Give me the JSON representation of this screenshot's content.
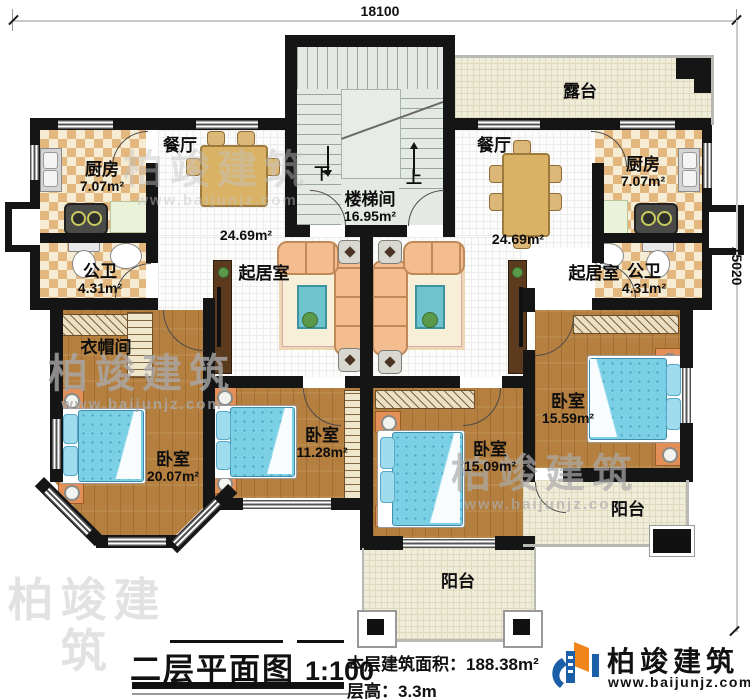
{
  "dimensions": {
    "width_top": "18100",
    "height_right": "15020"
  },
  "rooms": {
    "stairwell": {
      "name": "楼梯间",
      "area": "16.95m²"
    },
    "terrace": {
      "name": "露台"
    },
    "kitchen_left": {
      "name": "厨房",
      "area": "7.07m²"
    },
    "kitchen_right": {
      "name": "厨房",
      "area": "7.07m²"
    },
    "dining_left": {
      "name": "餐厅",
      "area": "24.69m²"
    },
    "dining_right": {
      "name": "餐厅",
      "area": "24.69m²"
    },
    "bath_left": {
      "name": "公卫",
      "area": "4.31m²"
    },
    "bath_right": {
      "name": "公卫",
      "area": "4.31m²"
    },
    "living_left": {
      "name": "起居室"
    },
    "living_right": {
      "name": "起居室"
    },
    "cloakroom": {
      "name": "衣帽间"
    },
    "bedroom_master_left": {
      "name": "卧室",
      "area": "20.07m²"
    },
    "bedroom_left_small": {
      "name": "卧室",
      "area": "11.28m²"
    },
    "bedroom_right_small": {
      "name": "卧室",
      "area": "15.09m²"
    },
    "bedroom_master_right": {
      "name": "卧室",
      "area": "15.59m²"
    },
    "balcony_center": {
      "name": "阳台"
    },
    "balcony_right": {
      "name": "阳台"
    }
  },
  "stairs": {
    "down": "下",
    "up": "上"
  },
  "legend": {
    "title": "二层平面图",
    "scale": "1:100",
    "area_label": "本层建筑面积：",
    "area_value": "188.38m²",
    "floor_height_label": "层高：",
    "floor_height_value": "3.3m"
  },
  "brand": {
    "name": "柏竣建筑",
    "website": "www.baijunjz.com"
  },
  "watermarks": [
    {
      "text": "柏竣建筑",
      "sub": "www.baijunjz.com"
    },
    {
      "text": "柏竣建筑",
      "sub": "www.baijunjz.com"
    },
    {
      "text": "柏竣建筑",
      "sub": "www.baijunjz.com"
    },
    {
      "text": "柏竣建筑",
      "sub": "www.baijunjz.com"
    }
  ],
  "colors": {
    "wall": "#151515",
    "wood_floor": "#b5803f",
    "checker_tile": "#e3b77d",
    "bed_blue": "#7bd0e6",
    "sofa_peach": "#f3bd90",
    "brand_blue": "#1a5fa8",
    "brand_orange": "#f08519"
  }
}
